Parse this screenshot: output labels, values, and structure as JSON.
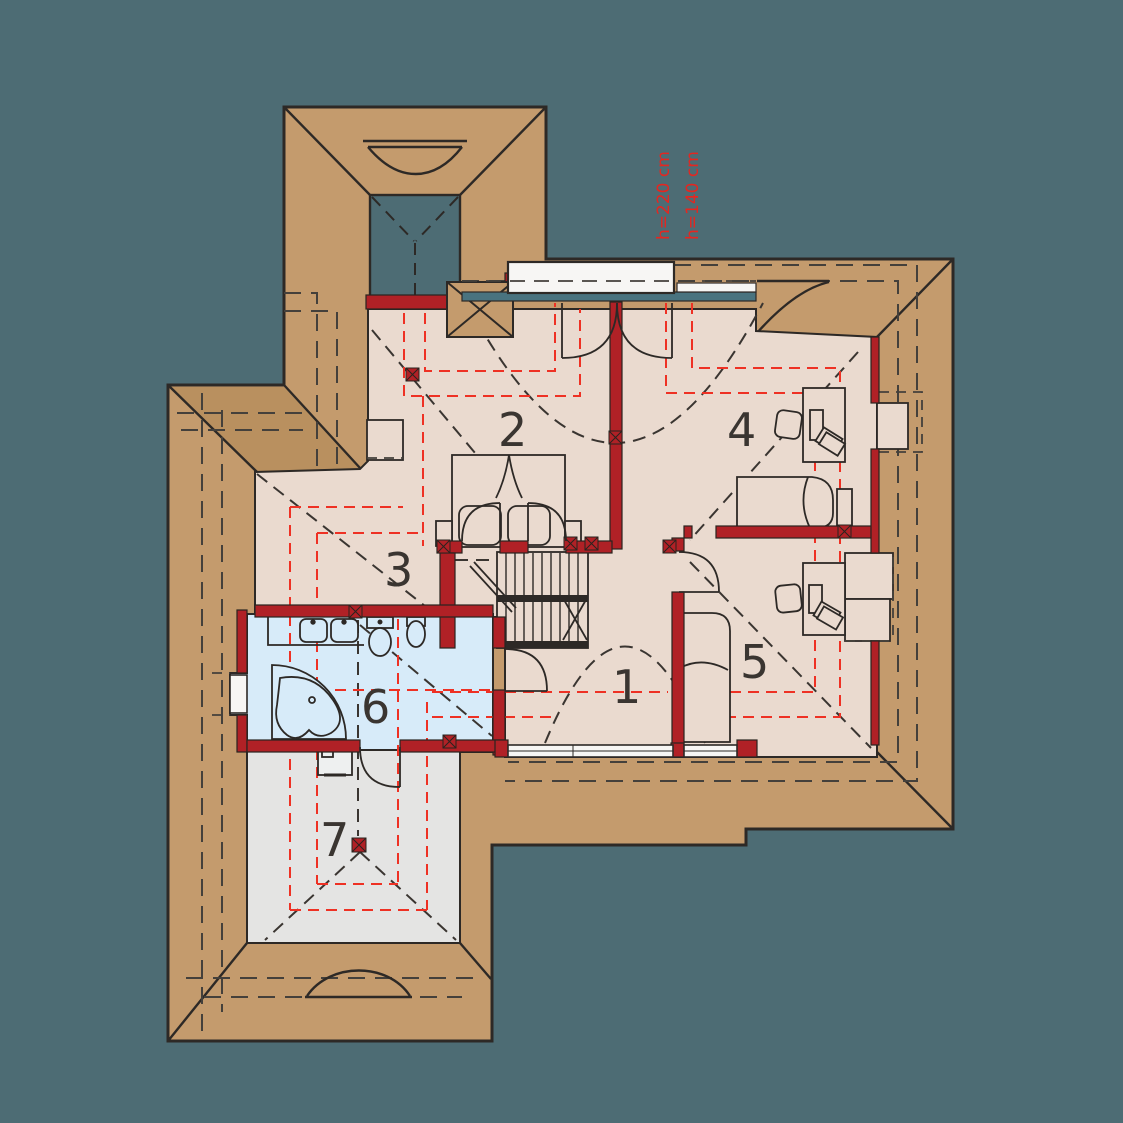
{
  "title": "Attic floor plan drawing",
  "annotations": {
    "height_line_upper": "h=220 cm",
    "height_line_lower": "h=140 cm"
  },
  "rooms": [
    {
      "number": "1",
      "note": "hall / landing"
    },
    {
      "number": "2",
      "note": "bedroom with double bed"
    },
    {
      "number": "3",
      "note": "open area by stairs"
    },
    {
      "number": "4",
      "note": "bedroom with desk"
    },
    {
      "number": "5",
      "note": "bedroom with desk"
    },
    {
      "number": "6",
      "note": "bathroom"
    },
    {
      "number": "7",
      "note": "attic storage"
    }
  ],
  "colors": {
    "background": "#4d6c74",
    "roof": "#c49b6d",
    "roof_shaded": "#b9905f",
    "floor": "#eadacf",
    "bathroom_floor": "#d7ebf9",
    "storage_floor": "#e4e4e3",
    "wall_red": "#b02126",
    "height_line_red": "#ee3124",
    "drawing_line": "#2d2926",
    "window_glass": "#49737f",
    "window_frame": "#f7f6f4"
  }
}
